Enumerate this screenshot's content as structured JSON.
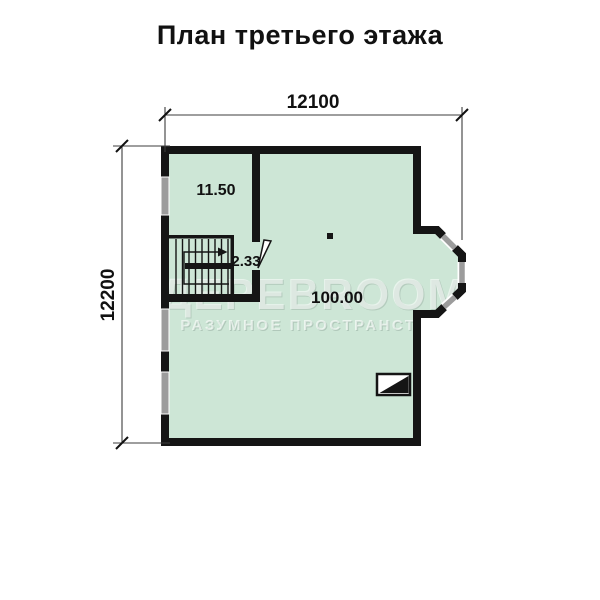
{
  "title": "План третьего этажа",
  "dimensions": {
    "top": "12100",
    "left": "12200"
  },
  "rooms": {
    "upper_left": "11.50",
    "stairs": "2.33",
    "main": "100.00"
  },
  "watermark": {
    "brand": "ДЕРЕВROOM",
    "slogan": "РАЗУМНОЕ  ПРОСТРАНСТВО"
  },
  "colors": {
    "floor": "#cde6d6",
    "wall": "#151515",
    "window": "#9c9c9c",
    "dim_line": "#3d3d3d",
    "text": "#111111",
    "watermark_dark": "#7d9187",
    "watermark_light": "#ffffff"
  }
}
